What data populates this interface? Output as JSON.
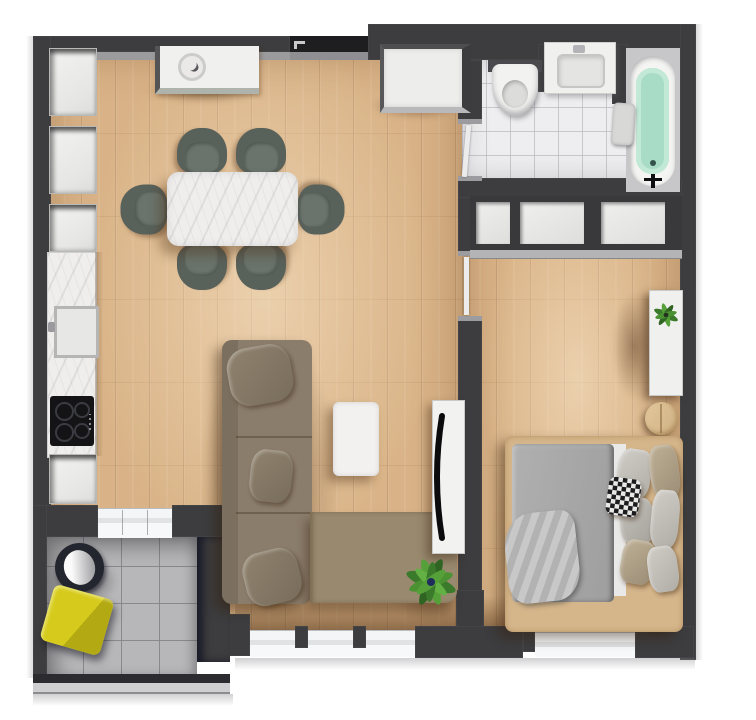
{
  "scene": {
    "description": "3D rendered one-bedroom apartment floor plan, top-down view",
    "width_px": 756,
    "height_px": 720
  },
  "palette": {
    "wall": "#3d3d3f",
    "wall_recess": "#1e1e20",
    "wood_floor": "#d9b387",
    "bath_tile": "#eeeef0",
    "balcony_tile": "#b7b7b9",
    "marble": "#efeeec",
    "sofa": "#8b7d6c",
    "sofa_chaise": "#98896f",
    "dining_chair": "#59615b",
    "duvet_gray": "#a9a9a9",
    "bed_frame": "#d5b58a",
    "tub_water": "#a8dcc6",
    "accent_yellow": "#c9c11b",
    "plant_green": "#4b9232",
    "tv_black": "#0b0b0d",
    "window_sill": "#f3f5f6"
  },
  "rooms": {
    "living_kitchen": {
      "label": "Open living room with kitchen",
      "floor": "light oak planks"
    },
    "bedroom": {
      "label": "Bedroom",
      "floor": "light oak planks"
    },
    "bathroom": {
      "label": "Bathroom",
      "floor": "white ceramic tile"
    },
    "balcony": {
      "label": "Balcony",
      "floor": "grey tile"
    }
  },
  "furniture": {
    "sofa": {
      "label": "L-shaped corner sofa, taupe",
      "pillow_count": 3
    },
    "coffee_table": {
      "label": "White coffee table"
    },
    "tv_stand": {
      "label": "TV stand with flat TV"
    },
    "floor_plant": {
      "label": "Potted green plant"
    },
    "dining_table": {
      "label": "Dining table with marble top"
    },
    "dining_chair": {
      "label": "Upholstered dining chair, dark sage",
      "count": 6
    },
    "sideboard": {
      "label": "Sideboard with decorative bowl"
    },
    "entry_cabinet": {
      "label": "Hallway cabinet"
    },
    "tall_cabinets": {
      "label": "Kitchen tall cabinet column",
      "count": 3
    },
    "counter": {
      "label": "Marble kitchen counter"
    },
    "sink": {
      "label": "Kitchen sink with faucet"
    },
    "cooktop": {
      "label": "Black induction cooktop",
      "burners": 4
    },
    "base_cabinet": {
      "label": "Kitchen base cabinet"
    },
    "wardrobe": {
      "label": "Built-in wardrobe",
      "sections": 3
    },
    "bed": {
      "label": "Double bed with grey duvet",
      "pillow_count": 7
    },
    "accent_pillow": {
      "label": "Black-and-white patterned cushion"
    },
    "blanket": {
      "label": "Crumpled grey blanket"
    },
    "dresser": {
      "label": "White console shelf with plant"
    },
    "bedside_stool": {
      "label": "Round wooden bedside table",
      "count": 2
    },
    "toilet": {
      "label": "Toilet"
    },
    "vanity": {
      "label": "Washbasin vanity with faucet"
    },
    "bathtub": {
      "label": "Bathtub filled with water"
    },
    "towel": {
      "label": "Towel over tub edge"
    },
    "lounge_chair": {
      "label": "Round balcony chair"
    },
    "yellow_stool": {
      "label": "Yellow cube seat"
    }
  },
  "openings": {
    "entrance": {
      "label": "Entrance door (top wall)"
    },
    "bathroom_door": {
      "label": "Bathroom door"
    },
    "bedroom_door": {
      "label": "Bedroom door"
    },
    "balcony_door": {
      "label": "Balcony glass sliding door"
    },
    "living_window": {
      "label": "Living room floor-to-ceiling window"
    },
    "bedroom_window": {
      "label": "Bedroom floor-to-ceiling window"
    },
    "railing": {
      "label": "Balcony glass railing"
    }
  }
}
